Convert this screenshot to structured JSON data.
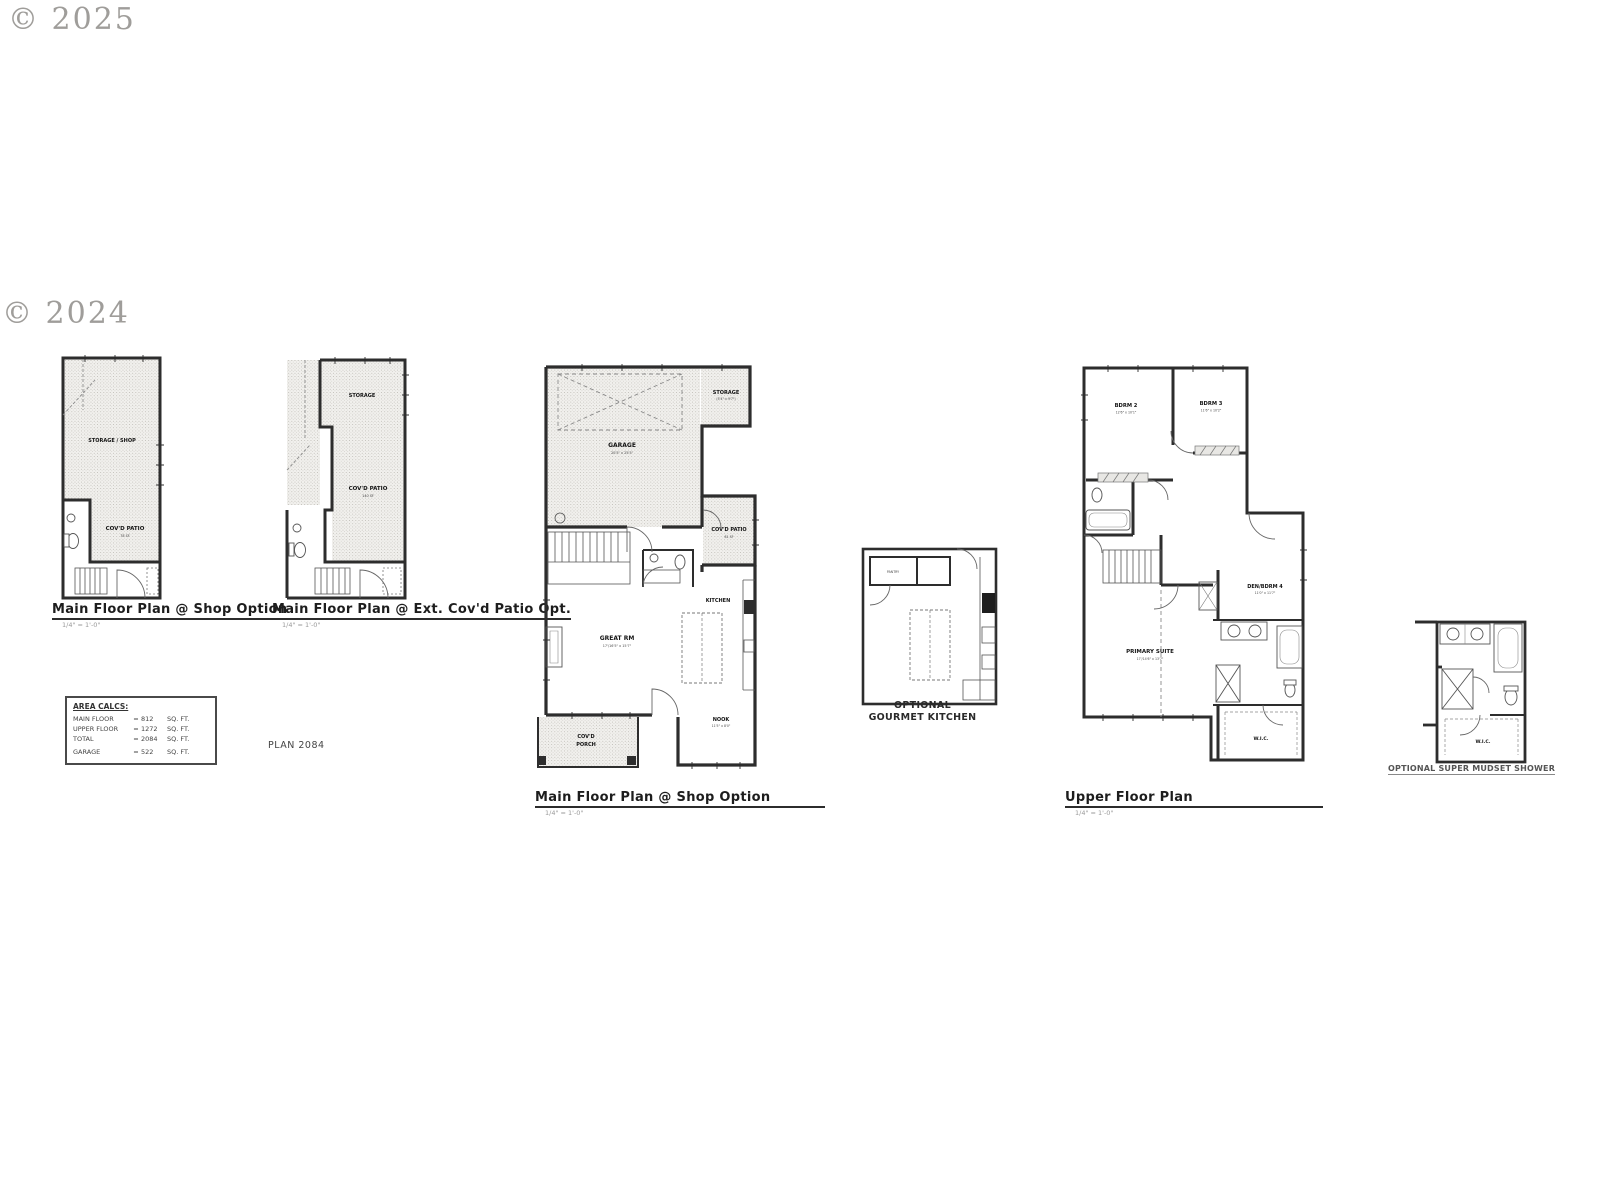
{
  "watermarks": {
    "top_left": "© 2025",
    "mid_left": "© 2024"
  },
  "plan_number": "PLAN 2084",
  "area_calcs": {
    "title": "AREA CALCS:",
    "rows": [
      {
        "label": "MAIN FLOOR",
        "eq": "=",
        "value": "812",
        "unit": "SQ. FT."
      },
      {
        "label": "UPPER FLOOR",
        "eq": "=",
        "value": "1272",
        "unit": "SQ. FT."
      },
      {
        "label": "TOTAL",
        "eq": "=",
        "value": "2084",
        "unit": "SQ. FT."
      },
      {
        "label": "GARAGE",
        "eq": "=",
        "value": "522",
        "unit": "SQ. FT."
      }
    ]
  },
  "plans": {
    "shop_small": {
      "title": "Main Floor Plan @ Shop Option",
      "scale": "1/4\" = 1'-0\"",
      "labels": {
        "storage_shop": "STORAGE / SHOP",
        "covd_patio": "COV'D PATIO",
        "patio_sf": "78 SF"
      }
    },
    "ext_patio": {
      "title": "Main Floor Plan @ Ext. Cov'd Patio Opt.",
      "scale": "1/4\" = 1'-0\"",
      "labels": {
        "storage": "STORAGE",
        "covd_patio": "COV'D PATIO",
        "patio_sf": "140 SF"
      }
    },
    "main_large": {
      "title": "Main Floor Plan @ Shop Option",
      "scale": "1/4\" = 1'-0\"",
      "labels": {
        "garage": "GARAGE",
        "garage_dims": "20'5\" x 25'5\"",
        "storage": "STORAGE",
        "storage_dims": "(5'4\" x 9'7\")",
        "covd_patio": "COV'D PATIO",
        "patio_sf": "81 SF",
        "great_rm": "GREAT RM",
        "great_rm_dims": "17'/16'5\" x 15'7\"",
        "kitchen": "KITCHEN",
        "nook": "NOOK",
        "nook_dims": "11'5\" x 8'0\"",
        "covd_porch_line1": "COV'D",
        "covd_porch_line2": "PORCH"
      }
    },
    "gourmet": {
      "caption_line1": "OPTIONAL",
      "caption_line2": "GOURMET KITCHEN",
      "labels": {
        "pantry": "PANTRY"
      }
    },
    "upper": {
      "title": "Upper Floor Plan",
      "scale": "1/4\" = 1'-0\"",
      "labels": {
        "bdrm2": "BDRM 2",
        "bdrm2_dims": "12'6\" x 10'1\"",
        "bdrm3": "BDRM 3",
        "bdrm3_dims": "11'6\" x 10'2\"",
        "den_bdrm4": "DEN/BDRM 4",
        "den_bdrm4_dims": "11'0\" x 11'7\"",
        "primary_suite": "PRIMARY SUITE",
        "primary_suite_dims": "17'/14'6\" x 13'7\"",
        "wic": "W.I.C."
      }
    },
    "mudset": {
      "caption": "OPTIONAL SUPER MUDSET SHOWER",
      "labels": {
        "wic": "W.I.C."
      }
    }
  }
}
